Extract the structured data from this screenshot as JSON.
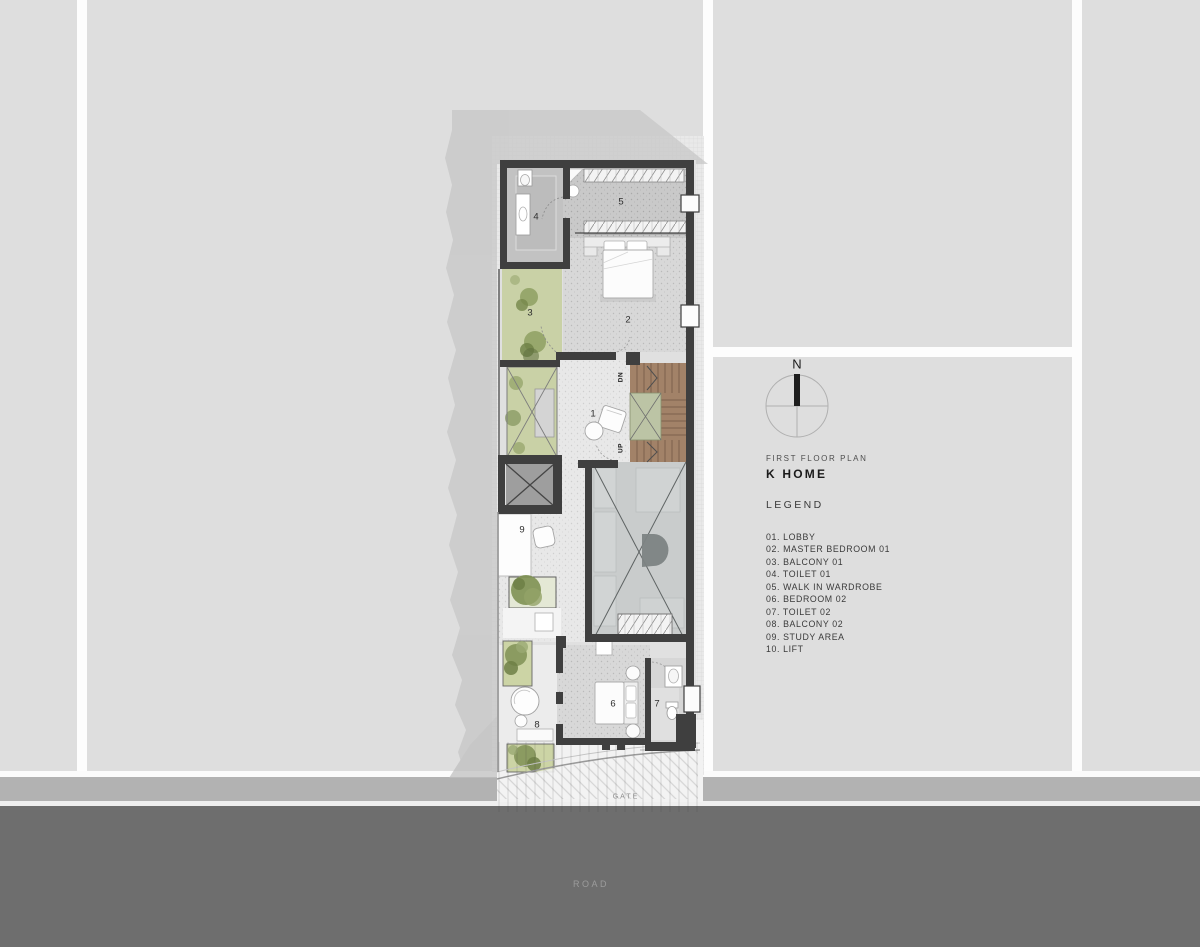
{
  "title_block": {
    "plan_type": "FIRST FLOOR PLAN",
    "project_name": "K HOME"
  },
  "legend": {
    "heading": "LEGEND",
    "items": [
      "01. LOBBY",
      "02. MASTER BEDROOM 01",
      "03. BALCONY 01",
      "04. TOILET 01",
      "05. WALK IN WARDROBE",
      "06. BEDROOM 02",
      "07. TOILET 02",
      "08. BALCONY 02",
      "09. STUDY AREA",
      "10. LIFT"
    ]
  },
  "north_indicator": {
    "label": "N"
  },
  "plan": {
    "room_labels": [
      {
        "number": "1",
        "name": "lobby"
      },
      {
        "number": "2",
        "name": "master-bedroom-01"
      },
      {
        "number": "3",
        "name": "balcony-01"
      },
      {
        "number": "4",
        "name": "toilet-01"
      },
      {
        "number": "5",
        "name": "walk-in-wardrobe"
      },
      {
        "number": "6",
        "name": "bedroom-02"
      },
      {
        "number": "7",
        "name": "toilet-02"
      },
      {
        "number": "8",
        "name": "balcony-02"
      },
      {
        "number": "9",
        "name": "study-area"
      }
    ],
    "stair_labels": {
      "down": "DN",
      "up": "UP"
    },
    "site_labels": {
      "gate": "GATE",
      "road": "ROAD"
    }
  },
  "colors": {
    "plot": "#dedede",
    "wall": "#3f3f3f",
    "road": "#6e6e6e",
    "sidewalk": "#b2b2b2",
    "planting_green": "#8c9c60",
    "stair_wood": "#a28268",
    "shadow": "#c6c6c6"
  }
}
